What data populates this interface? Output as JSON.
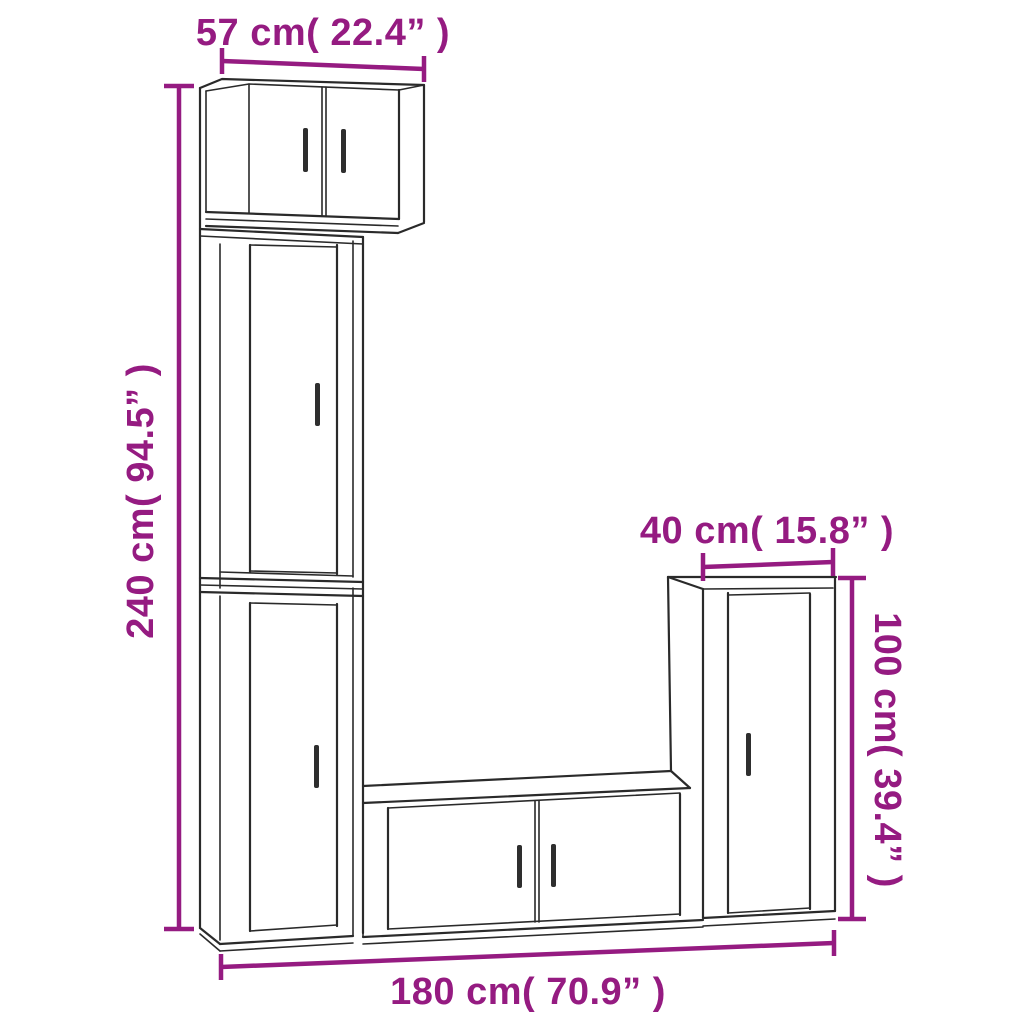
{
  "diagram": {
    "background": "#ffffff",
    "outline_color": "#2a2a2a",
    "dimension_color": "#951B81",
    "handle_color": "#2e2e2e",
    "labels": {
      "top_width": "57 cm( 22.4” )",
      "left_height": "240 cm( 94.5” )",
      "right_cabinet_width": "40 cm( 15.8” )",
      "right_cabinet_height": "100 cm( 39.4” )",
      "bottom_width": "180 cm( 70.9” )"
    },
    "units": [
      {
        "name": "wall-cabinet-top",
        "doors": 2
      },
      {
        "name": "tall-cabinet-upper",
        "doors": 1
      },
      {
        "name": "tall-cabinet-lower",
        "doors": 1
      },
      {
        "name": "tv-bench-bottom",
        "doors": 2
      },
      {
        "name": "side-cabinet-right",
        "doors": 1
      }
    ]
  }
}
